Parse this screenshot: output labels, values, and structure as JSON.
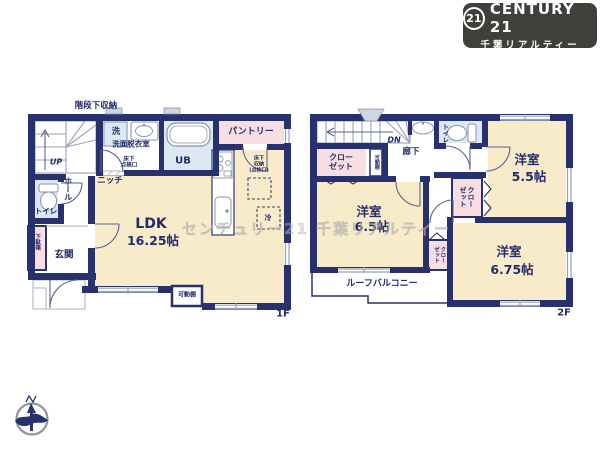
{
  "logo": {
    "badge": "21",
    "brand": "CENTURY 21",
    "subtitle": "千葉リアルティー",
    "bg_color": "#3f403c",
    "text_color": "#ffffff"
  },
  "watermark": "センチュリー21 千葉リアルティー",
  "palette": {
    "wall_navy": "#28306d",
    "room_cream": "#f8ebca",
    "room_blue": "#dce8f4",
    "room_pink": "#f8dee2",
    "text_navy": "#232c6b"
  },
  "floor1": {
    "floor_label": "1F",
    "labels": {
      "stair_storage": "階段下収納",
      "up": "UP",
      "hall": "ホール",
      "toilet": "トイレ",
      "shoe_box": "下駄箱",
      "entrance": "玄関",
      "washer": "洗",
      "washroom": "洗面脱衣室",
      "floor_hatch": "床下\n点検口",
      "bath": "UB",
      "pantry": "パントリー",
      "niche": "ニッチ",
      "floor_storage": "床下\n収納\n(点検口)",
      "ldk": "LDK",
      "ldk_size": "16.25帖",
      "shelf": "可動棚",
      "fridge": "冷"
    }
  },
  "floor2": {
    "floor_label": "2F",
    "labels": {
      "dn": "DN",
      "corridor": "廊下",
      "closet_nw": "クロー\nゼット",
      "shelf": "可動棚",
      "toilet": "トイレ",
      "room_a": "洋室",
      "room_a_size": "5.5帖",
      "closet_center": "クロー\nゼット",
      "room_b": "洋室",
      "room_b_size": "6.5帖",
      "closet_small": "クロー\nゼット",
      "room_c": "洋室",
      "room_c_size": "6.75帖",
      "balcony": "ルーフバルコニー"
    }
  }
}
